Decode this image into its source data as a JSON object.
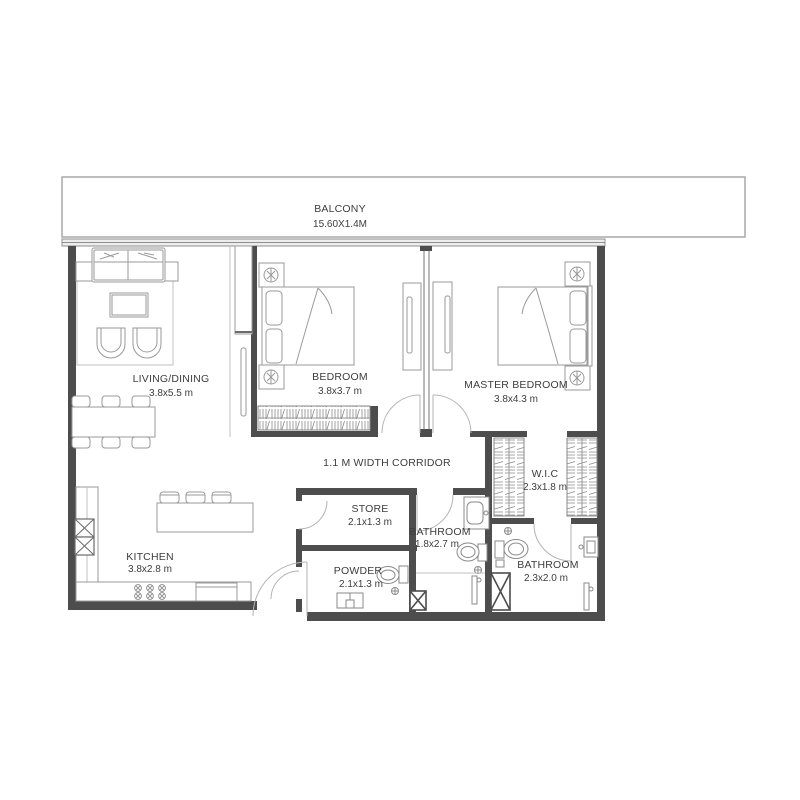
{
  "plan": {
    "balcony": {
      "name": "BALCONY",
      "dims": "15.60X1.4M"
    },
    "living": {
      "name": "LIVING/DINING",
      "dims": "3.8x5.5 m"
    },
    "bedroom": {
      "name": "BEDROOM",
      "dims": "3.8x3.7 m"
    },
    "master": {
      "name": "MASTER BEDROOM",
      "dims": "3.8x4.3 m"
    },
    "corridor": {
      "name": "1.1 M WIDTH CORRIDOR"
    },
    "store": {
      "name": "STORE",
      "dims": "2.1x1.3 m"
    },
    "bathroom1": {
      "name": "BATHROOM",
      "dims": "1.8x2.7 m"
    },
    "wic": {
      "name": "W.I.C",
      "dims": "2.3x1.8 m"
    },
    "bathroom2": {
      "name": "BATHROOM",
      "dims": "2.3x2.0 m"
    },
    "powder": {
      "name": "POWDER",
      "dims": "2.1x1.3 m"
    },
    "kitchen": {
      "name": "KITCHEN",
      "dims": "3.8x2.8 m"
    },
    "colors": {
      "wall": "#4d4d4d",
      "line": "#9a9a9a",
      "text": "#3d3d3d",
      "background": "#ffffff"
    }
  }
}
